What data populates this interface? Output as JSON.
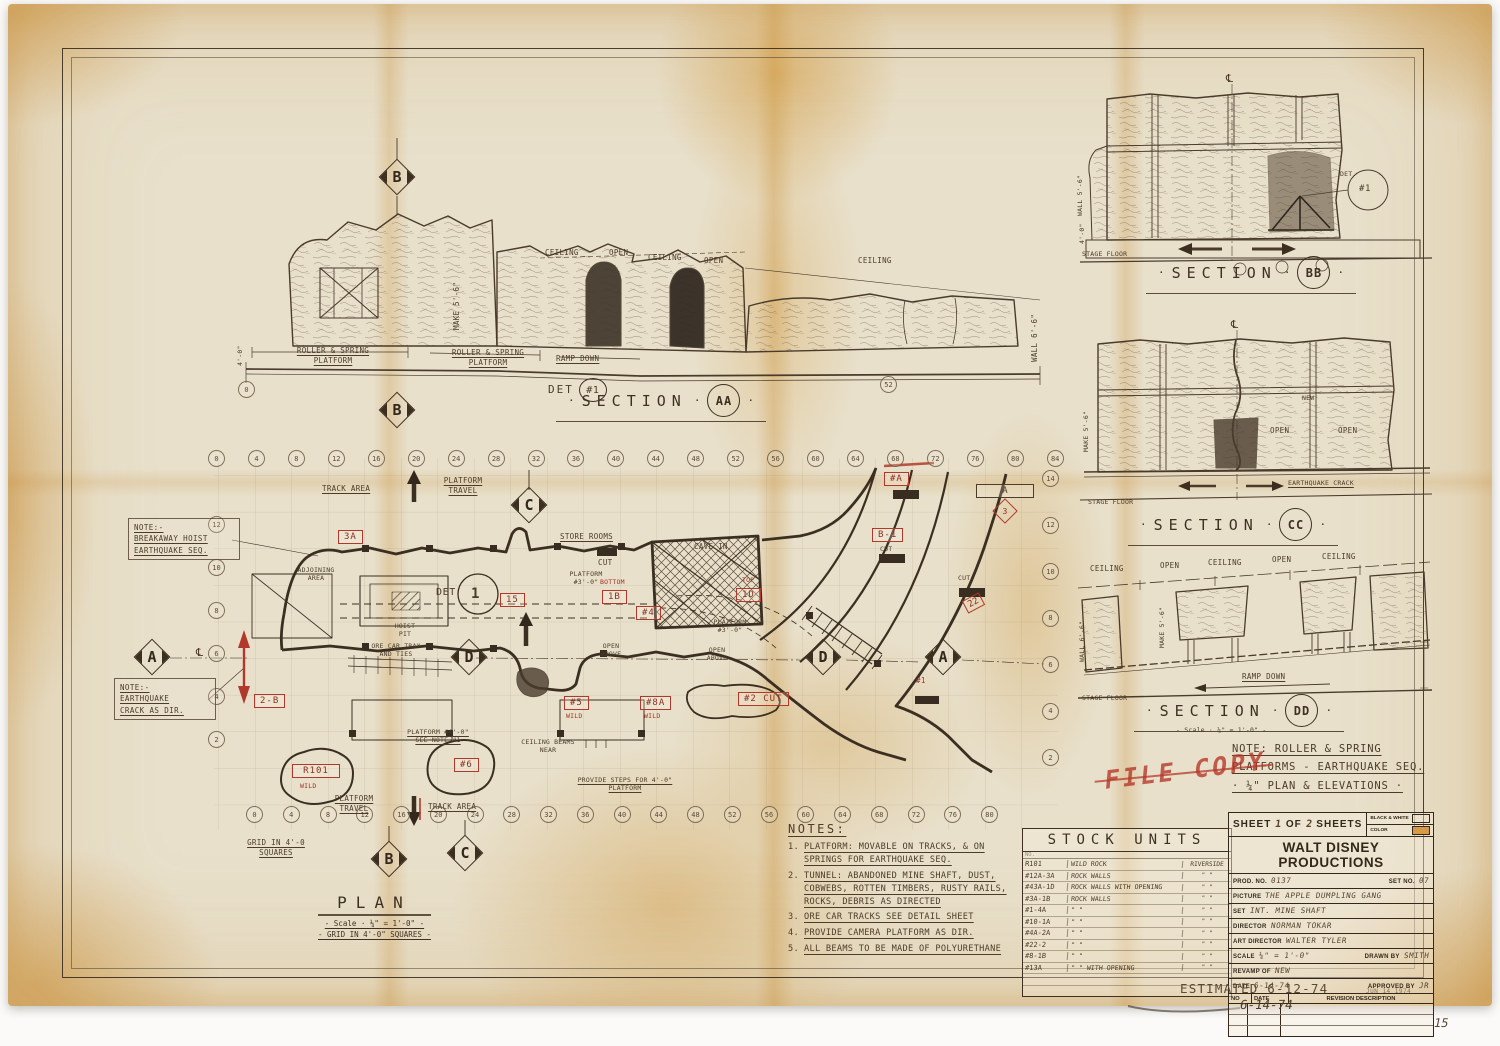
{
  "colors": {
    "red_ink": "#b0392b",
    "ink": "#463827",
    "paper": "#e8e0cb",
    "stain": "#d49a45"
  },
  "markers": {
    "a": "A",
    "b": "B",
    "c": "C",
    "d": "D"
  },
  "centerline": "℄",
  "sections": {
    "aa": {
      "title": "SECTION",
      "bubble": "AA"
    },
    "bb": {
      "title": "SECTION",
      "bubble": "BB"
    },
    "cc": {
      "title": "SECTION",
      "bubble": "CC"
    },
    "dd": {
      "title": "SECTION",
      "bubble": "DD",
      "scale": "- Scale · ¼\" = 1'-0\" -"
    }
  },
  "labels": {
    "ceiling": "CEILING",
    "open": "OPEN",
    "roller_spring": "ROLLER & SPRING",
    "platform": "PLATFORM",
    "travel": "TRAVEL",
    "ramp_down": "RAMP DOWN",
    "det": "DET",
    "det_no": "#1",
    "det_dot": "DET.",
    "one": "1",
    "stage_floor": "STAGE FLOOR",
    "wall_5_6": "WALL 5'-6\"",
    "wall_6_6": "WALL 6'-6\"",
    "make_5_6": "MAKE 5'-6\"",
    "dim_4_0": "4'-0\"",
    "earthquake_crack": "EARTHQUAKE CRACK",
    "new": "NEW",
    "track_area": "TRACK AREA",
    "adjoining": "ADJOINING",
    "area": "AREA",
    "hoist": "HOIST",
    "pit": "PIT",
    "store_rooms": "STORE ROOMS",
    "cut": "CUT",
    "top": "TOP",
    "bottom": "BOTTOM",
    "platform_3_0a": "PLATFORM",
    "platform_3_0b": "#3'-0\"",
    "cave_in": "CAVE IN",
    "open_above1": "OPEN",
    "open_above2": "ABOVE",
    "ore_car1": "ORE CAR TRAX",
    "ore_car2": "AND TIES",
    "ceiling_beams1": "CEILING BEAMS",
    "ceiling_beams2": "NEAR",
    "platform_4_0": "PLATFORM #4'-0\"",
    "see_note_1": "SEE NOTE #1",
    "provide_steps1": "PROVIDE STEPS FOR 4'-0\"",
    "provide_steps2": "PLATFORM",
    "grid_small1": "GRID IN 4'-0",
    "grid_small2": "SQUARES",
    "note_breakaway": [
      "NOTE:-",
      "BREAKAWAY HOIST",
      "EARTHQUAKE SEQ."
    ],
    "note_crack": [
      "NOTE:-",
      "EARTHQUAKE",
      "CRACK AS DIR."
    ]
  },
  "tags": {
    "t3a": "3A",
    "t15": "15",
    "t1b": "1B",
    "t4": "#4",
    "t1d": "1D",
    "tb1": "B-1",
    "ta": "#A",
    "ta_box": "A",
    "t3": "3",
    "t22": "22",
    "t2b": "2-B",
    "t5": "#5",
    "t8a": "#8A",
    "t2cut": "#2 CUT",
    "t1": "#1",
    "tr101": "R101",
    "twild": "WILD",
    "t6": "#6"
  },
  "plan": {
    "title": "PLAN",
    "scale": "- Scale · ¼\" = 1'-0\" -",
    "grid_note": "- GRID IN 4'-0\" SQUARES -",
    "grid_bottom": [
      "0",
      "4",
      "8",
      "12",
      "16",
      "20",
      "24",
      "28",
      "32",
      "36",
      "40",
      "44",
      "48",
      "52",
      "56",
      "60",
      "64",
      "68",
      "72",
      "76",
      "80"
    ],
    "grid_top": [
      "0",
      "4",
      "8",
      "12",
      "16",
      "20",
      "24",
      "28",
      "32",
      "36",
      "40",
      "44",
      "48",
      "52",
      "56",
      "60",
      "64",
      "68",
      "72",
      "76",
      "80",
      "84"
    ],
    "grid_right": [
      "14",
      "12",
      "10",
      "8",
      "6",
      "4",
      "2"
    ],
    "grid_left": [
      "12",
      "10",
      "8",
      "6",
      "4",
      "2"
    ],
    "aa_tick_0": "0",
    "aa_tick_52": "52"
  },
  "notes": {
    "heading": "NOTES:",
    "items": [
      {
        "no": "1.",
        "text": "PLATFORM: MOVABLE ON TRACKS, & ON SPRINGS FOR EARTHQUAKE SEQ."
      },
      {
        "no": "2.",
        "text": "TUNNEL: ABANDONED MINE SHAFT, DUST, COBWEBS, ROTTEN TIMBERS, RUSTY RAILS, ROCKS, DEBRIS AS DIRECTED"
      },
      {
        "no": "3.",
        "text": "ORE CAR TRACKS SEE DETAIL SHEET"
      },
      {
        "no": "4.",
        "text": "PROVIDE CAMERA PLATFORM AS DIR."
      },
      {
        "no": "5.",
        "text": "ALL BEAMS TO BE MADE OF POLYURETHANE"
      }
    ]
  },
  "stock_units": {
    "title": "STOCK UNITS",
    "headers": [
      "NO.",
      "",
      ""
    ],
    "rows": [
      {
        "no": "R101",
        "desc": "WILD ROCK",
        "loc": "RIVERSIDE"
      },
      {
        "no": "#12A-3A",
        "desc": "ROCK WALLS",
        "loc": "\"  \""
      },
      {
        "no": "#43A-1D",
        "desc": "ROCK WALLS WITH OPENING",
        "loc": "\"  \""
      },
      {
        "no": "#3A-1B",
        "desc": "ROCK WALLS",
        "loc": "\"  \""
      },
      {
        "no": "#1-4A",
        "desc": "\"    \"",
        "loc": "\"  \""
      },
      {
        "no": "#10-1A",
        "desc": "\"    \"",
        "loc": "\"  \""
      },
      {
        "no": "#4A-2A",
        "desc": "\"    \"",
        "loc": "\"  \""
      },
      {
        "no": "#22-2",
        "desc": "\"    \"",
        "loc": "\"  \""
      },
      {
        "no": "#8-1B",
        "desc": "\"    \"",
        "loc": "\"  \""
      },
      {
        "no": "#13A",
        "desc": "\"    \"  WITH OPENING",
        "loc": "\"  \""
      }
    ]
  },
  "title_block": {
    "sheet_label": "SHEET",
    "sheet_no": "1",
    "of": "OF",
    "sheet_total": "2",
    "sheets": "SHEETS",
    "bw": "BLACK & WHITE",
    "color": "COLOR",
    "company": "WALT DISNEY PRODUCTIONS",
    "prod_label": "PROD. NO.",
    "prod_no": "0137",
    "set_no_label": "SET NO.",
    "set_no": "07",
    "picture_label": "PICTURE",
    "picture": "THE APPLE DUMPLING GANG",
    "set_label": "SET",
    "set": "INT. MINE SHAFT",
    "director_label": "DIRECTOR",
    "director": "NORMAN TOKAR",
    "art_director_label": "ART DIRECTOR",
    "art_director": "WALTER TYLER",
    "scale_label": "SCALE",
    "scale": "¼\" = 1'-0\"",
    "drawn_label": "DRAWN BY",
    "drawn_by": "SMITH",
    "revamp_label": "REVAMP OF",
    "revamp": "NEW",
    "date_label": "DATE",
    "date": "6-14-74",
    "approved_label": "APPROVED BY",
    "approved": "JR",
    "rev_no": "NO",
    "rev_date": "DATE",
    "rev_desc": "REVISION DESCRIPTION"
  },
  "side_note": {
    "line1": "NOTE: ROLLER & SPRING",
    "line2": "PLATFORMS - EARTHQUAKE SEQ.",
    "line3": "· ¼\" PLAN & ELEVATIONS ·"
  },
  "stamps": {
    "file_copy": "FILE COPY",
    "estimated": "ESTIMATED 6-12-74",
    "estimated2": "6-14-74",
    "date_stamp": "JUN 14 1974",
    "page_no": "15"
  }
}
